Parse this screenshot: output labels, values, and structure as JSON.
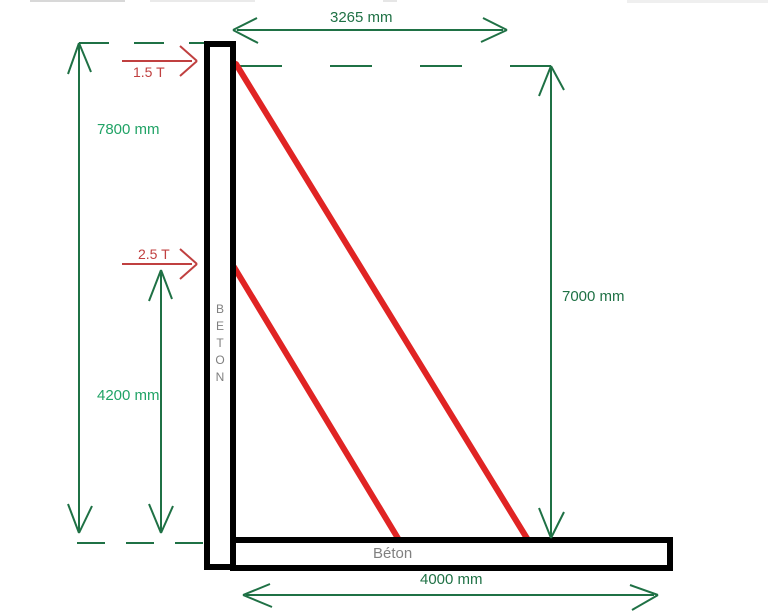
{
  "diagram": {
    "structure": {
      "wall_label": "BETON",
      "slab_label": "Béton"
    },
    "dimensions": {
      "top_width": "3265 mm",
      "wall_height": "7800 mm",
      "lower_left_height": "4200 mm",
      "right_height": "7000 mm",
      "base_width": "4000 mm"
    },
    "loads": {
      "upper": "1.5 T",
      "lower": "2.5 T"
    },
    "colors": {
      "dimension_line": "#1f7145",
      "dimension_label_light": "#21a366",
      "load_arrow": "#c04040",
      "tie_rod": "#e02424",
      "structure_outline": "#000000",
      "concrete_label": "#808080"
    }
  }
}
